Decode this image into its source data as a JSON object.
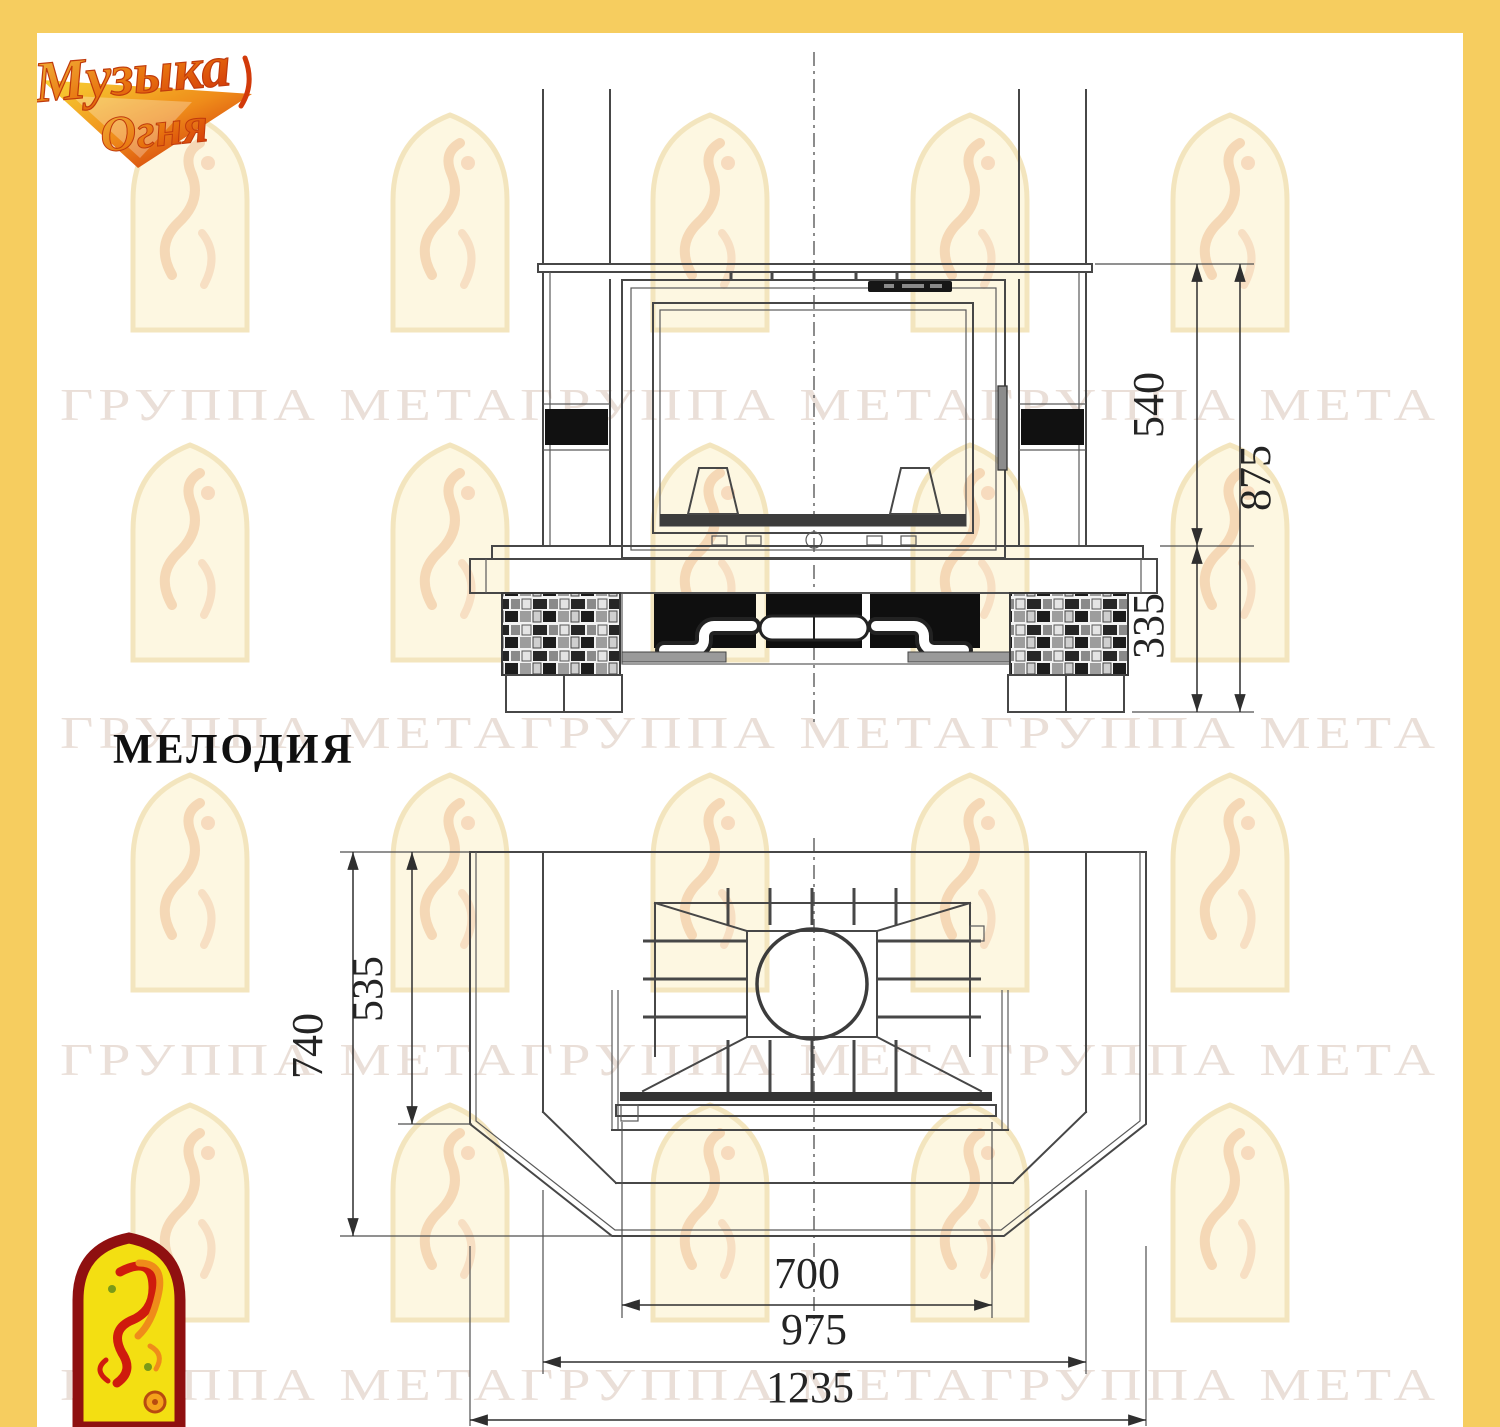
{
  "title": {
    "model_name": "МЕЛОДИЯ"
  },
  "branding": {
    "logo_top": {
      "word1": "Музыка",
      "word2": "Огня"
    },
    "watermark_text": "ГРУППА МЕТАГРУППА МЕТАГРУППА МЕТА"
  },
  "front_view": {
    "view_name": "front-elevation",
    "dimensions": {
      "firebox_height": "540",
      "total_height": "875",
      "base_height": "335"
    }
  },
  "plan_view": {
    "view_name": "plan",
    "dimensions": {
      "depth_total": "740",
      "depth_front": "535",
      "width_firebox": "700",
      "width_portal": "975",
      "width_total": "1235"
    }
  },
  "colors": {
    "frame_border": "#f6cd5f",
    "drawing_line": "#474747",
    "niche_black": "#0f0f0f",
    "logo_red": "#cf1b0d",
    "logo_orange": "#ef8c1a",
    "logo_yellow": "#f3df12"
  }
}
